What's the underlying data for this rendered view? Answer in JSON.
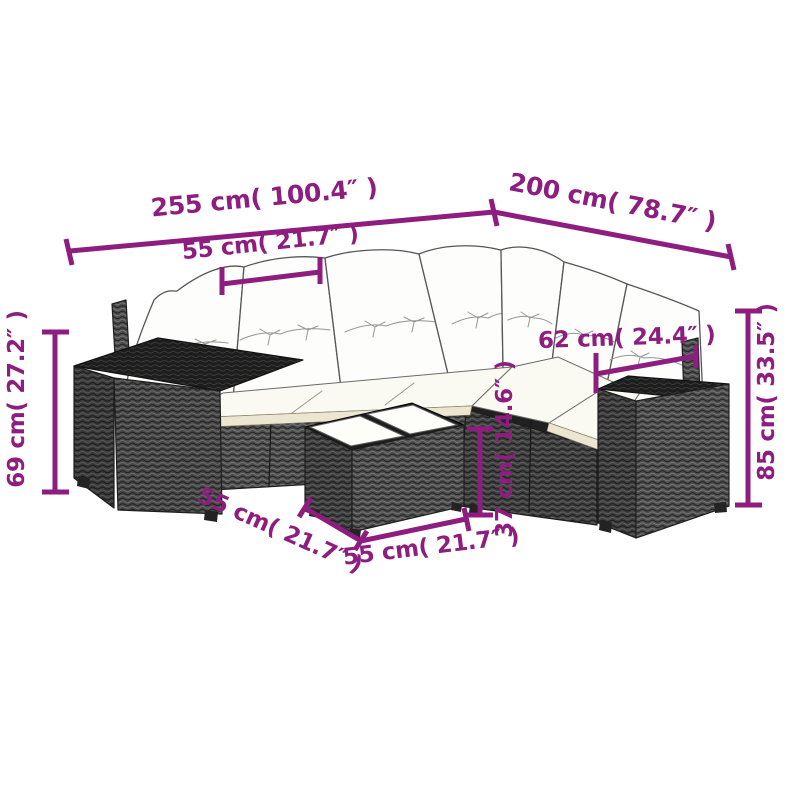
{
  "scene": {
    "background": "#ffffff",
    "illustration": "rattan-corner-sofa-set-line-drawing",
    "back_cushions": 7,
    "glass_panels": 2
  },
  "colors": {
    "dimension": "#8e1d80",
    "wicker": "#4e4e4e",
    "wicker_top": "#1d1d1d",
    "cushion": "#fdfdfc",
    "seat_trim": "#ece5d0"
  },
  "dimensions": {
    "overall_width": {
      "label": "255 cm( 100.4″ )"
    },
    "overall_depth": {
      "label": "200 cm( 78.7″ )"
    },
    "seat_width": {
      "label": "55 cm( 21.7″ )"
    },
    "armrest_depth": {
      "label": "62 cm( 24.4″ )"
    },
    "seat_height": {
      "label": "69 cm( 27.2″ )"
    },
    "total_height": {
      "label": "85 cm( 33.5″ )"
    },
    "table_height": {
      "label": "37 cm( 14.6″ )"
    },
    "table_length": {
      "label": "55 cm( 21.7″ )"
    },
    "table_width": {
      "label": "55 cm( 21.7″ )"
    }
  }
}
